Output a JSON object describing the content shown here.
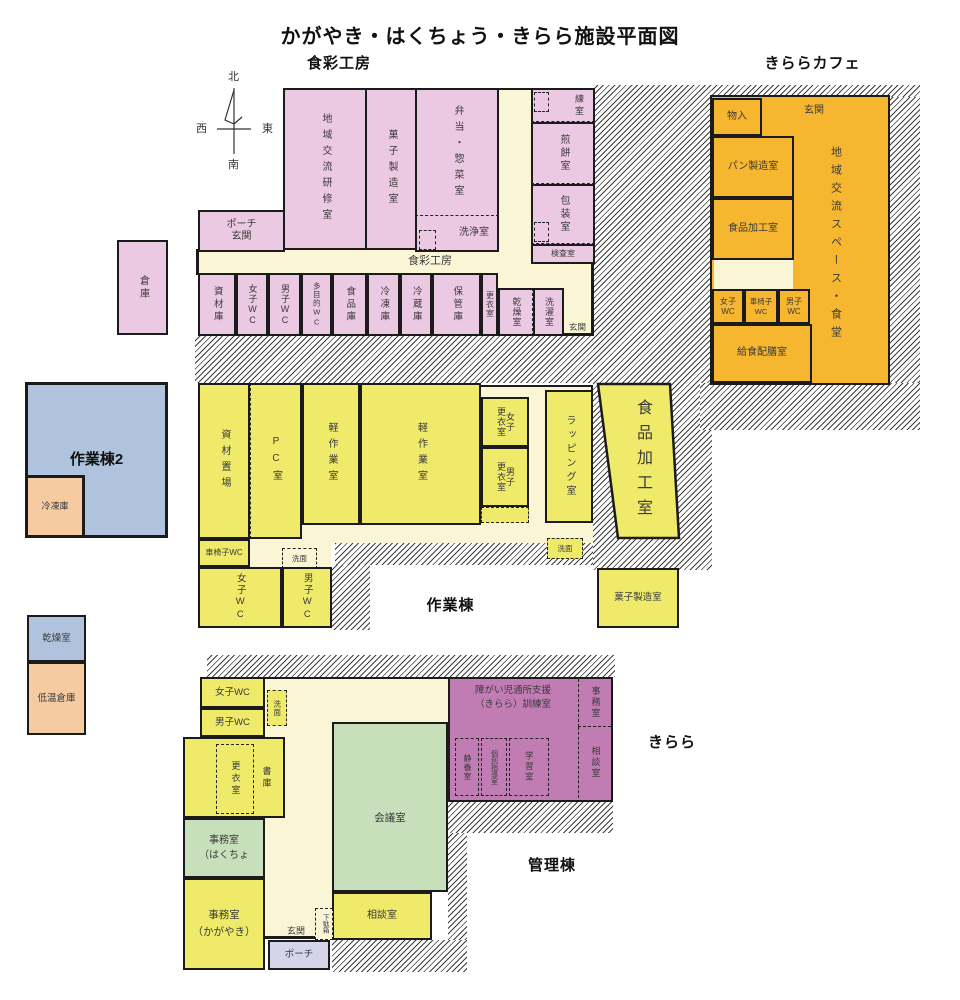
{
  "title": "かがやき・はくちょう・きらら施設平面図",
  "compass": {
    "north": "北",
    "south": "南",
    "east": "東",
    "west": "西"
  },
  "colors": {
    "pink": "#ecc9e2",
    "cream": "#faf6d5",
    "orange": "#f6b62f",
    "yellow": "#f0ea6a",
    "blue": "#afc3de",
    "peach": "#f6cba2",
    "purple": "#c17cb4",
    "green": "#c7dfba",
    "lavender": "#d6d4e8",
    "wall": "#1b1b1b"
  },
  "shokusai": {
    "name": "食彩工房",
    "corridor": "食彩工房",
    "rooms": {
      "chiiki": "地域交流研修室",
      "kashi": "菓子製造室",
      "bento": "弁当・惣菜室",
      "senjo": "洗浄室",
      "neri": "練室",
      "senbei": "煎餅室",
      "hoso": "包装室",
      "kensa": "検査室",
      "porch": "ポーチ\n玄関",
      "soko": "倉庫",
      "shizai": "資材庫",
      "joshi_wc": "女子WC",
      "danshi_wc": "男子WC",
      "tamokuteki_wc": "多目的WC",
      "shokuhin": "食品庫",
      "reito": "冷凍庫",
      "reizo": "冷蔵庫",
      "hokan": "保管庫",
      "koi": "更衣室",
      "kanso": "乾燥室",
      "sentaku": "洗濯室",
      "genkan": "玄関"
    }
  },
  "cafe": {
    "name": "きららカフェ",
    "rooms": {
      "mononyu": "物入",
      "genkan": "玄関",
      "pan": "パン製造室",
      "kako": "食品加工室",
      "joshi_wc": "女子WC",
      "kurumaisu_wc": "車椅子WC",
      "danshi_wc": "男子WC",
      "kyushoku": "給食配膳室",
      "space": "地域交流スペース・食堂"
    }
  },
  "sagyoto2": {
    "name": "作業棟2",
    "rooms": {
      "reito": "冷凍庫"
    }
  },
  "annex": {
    "kanso": "乾燥室",
    "teion": "低温倉庫"
  },
  "sagyoto": {
    "name": "作業棟",
    "rooms": {
      "shizai_okiba": "資材置場",
      "pc": "PC室",
      "keisagyo": "軽作業室",
      "joshi_koi": "女子\n更衣室",
      "danshi_koi": "男子\n更衣室",
      "wrapping": "ラッピング室",
      "kako": "食品加工室",
      "kurumaisu_wc": "車椅子WC",
      "joshi_wc": "女子WC",
      "danshi_wc": "男子WC",
      "senmen": "洗面",
      "kashi": "菓子製造室"
    }
  },
  "kirara": {
    "name": "きらら",
    "rooms": {
      "kunren": "障がい児通所支援\n（きらら）訓練室",
      "jimu": "事務室",
      "sodan": "相談室",
      "seiyo": "静養室",
      "kobetsu": "個別指導室",
      "gakushu": "学習室"
    }
  },
  "kanri": {
    "name": "管理棟",
    "rooms": {
      "joshi_wc": "女子WC",
      "danshi_wc": "男子WC",
      "senmen": "洗面",
      "koi": "更衣室",
      "shoko": "書庫",
      "kaigi": "会議室",
      "jimu_hakucho": "事務室\n（はくちょ",
      "jimu_kagayaki": "事務室\n（かがやき）",
      "sodan": "相談室",
      "getabako": "下駄箱",
      "genkan": "玄関",
      "porch": "ポーチ"
    }
  }
}
